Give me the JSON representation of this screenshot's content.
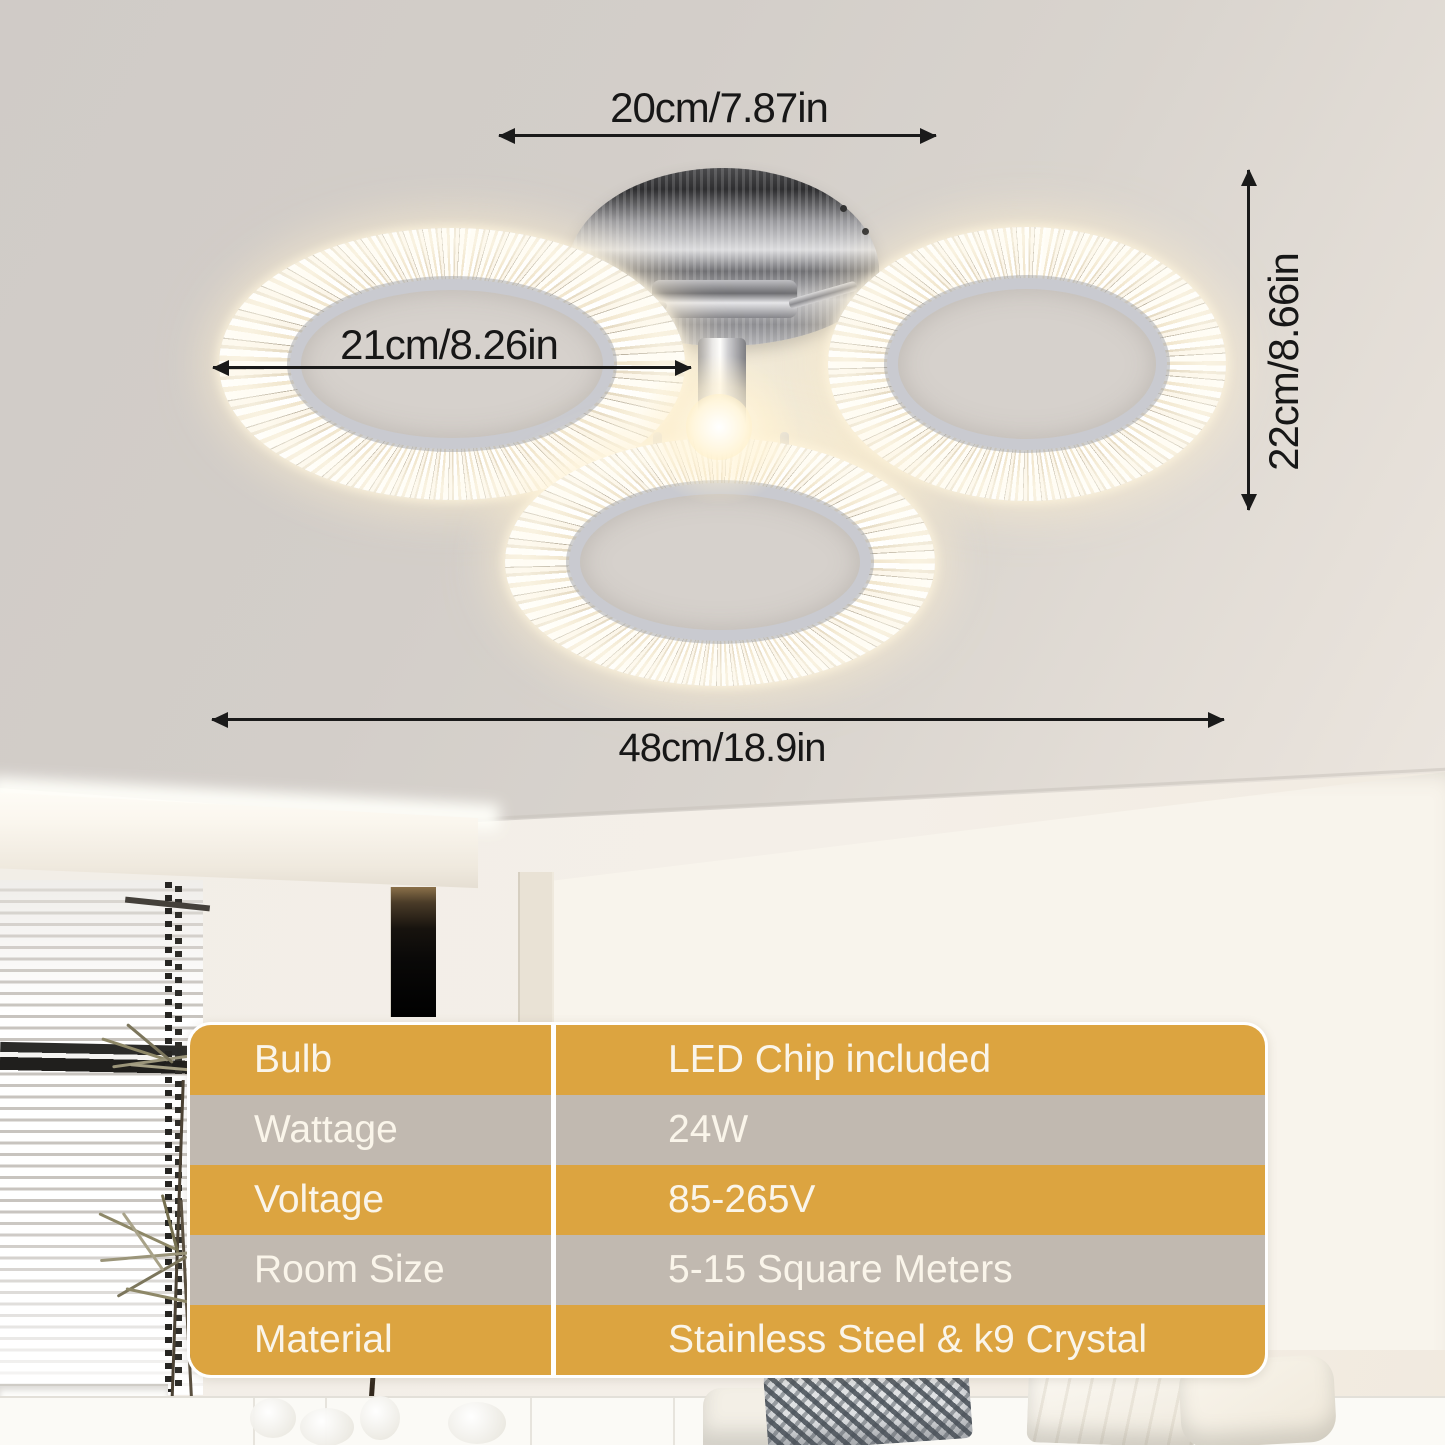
{
  "annotations": {
    "canopy_width": "20cm/7.87in",
    "ring_diameter": "21cm/8.26in",
    "fixture_height": "22cm/8.66in",
    "total_width": "48cm/18.9in"
  },
  "spec_table": {
    "rows": [
      {
        "label": "Bulb",
        "value": "LED Chip included"
      },
      {
        "label": "Wattage",
        "value": "24W"
      },
      {
        "label": "Voltage",
        "value": "85-265V"
      },
      {
        "label": "Room Size",
        "value": "5-15 Square Meters"
      },
      {
        "label": "Material",
        "value": "Stainless Steel & k9 Crystal"
      }
    ],
    "colors": {
      "accent_orange": "#DCA440",
      "alt_gray": "#C1B9B0",
      "text": "#FAF5EA",
      "divider": "#FFFFFF"
    }
  },
  "scene_colors": {
    "ceiling": "#D3CEC9",
    "wall": "#F2EEE7",
    "arrow": "#1A1A1A",
    "lamp_glow": "#FFF4DC"
  }
}
